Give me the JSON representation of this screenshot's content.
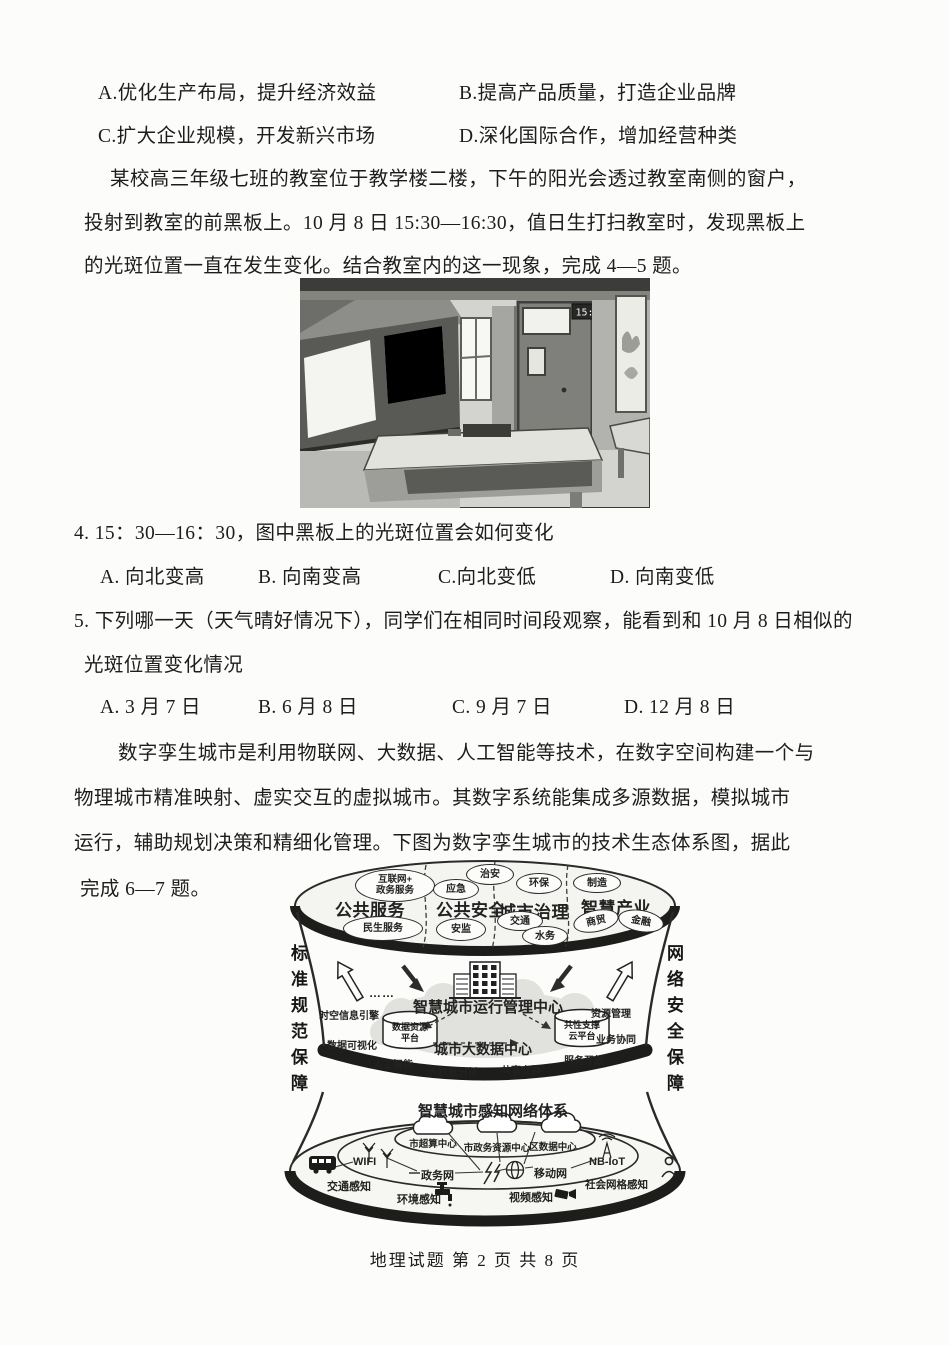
{
  "page": {
    "footer": "地理试题  第 2 页 共 8 页"
  },
  "prev_question": {
    "option_a": "A.优化生产布局，提升经济效益",
    "option_b": "B.提高产品质量，打造企业品牌",
    "option_c": "C.扩大企业规模，开发新兴市场",
    "option_d": "D.深化国际合作，增加经营种类"
  },
  "passage_classroom": {
    "line1": "某校高三年级七班的教室位于教学楼二楼，下午的阳光会透过教室南侧的窗户，",
    "line2": "投射到教室的前黑板上。10 月 8 日 15:30—16:30，值日生打扫教室时，发现黑板上",
    "line3": "的光斑位置一直在发生变化。结合教室内的这一现象，完成 4—5 题。"
  },
  "classroom_photo": {
    "clock_time": "15:30"
  },
  "question4": {
    "stem": "4. 15：30—16：30，图中黑板上的光斑位置会如何变化",
    "option_a": "A. 向北变高",
    "option_b": "B. 向南变高",
    "option_c": "C.向北变低",
    "option_d": "D. 向南变低"
  },
  "question5": {
    "stem_line1": "5. 下列哪一天（天气晴好情况下），同学们在相同时间段观察，能看到和 10 月 8 日相似的",
    "stem_line2": "光斑位置变化情况",
    "option_a": "A. 3 月 7 日",
    "option_b": "B. 6 月 8 日",
    "option_c": "C. 9 月 7 日",
    "option_d": "D. 12 月 8 日"
  },
  "passage_twin_city": {
    "line1": "数字孪生城市是利用物联网、大数据、人工智能等技术，在数字空间构建一个与",
    "line2": "物理城市精准映射、虚实交互的虚拟城市。其数字系统能集成多源数据，模拟城市",
    "line3": "运行，辅助规划决策和精细化管理。下图为数字孪生城市的技术生态体系图，据此",
    "line4": "完成 6—7 题。"
  },
  "diagram": {
    "left_guarantee": "标准规范保障",
    "right_guarantee": "网络安全保障",
    "sectors": {
      "s1": "公共服务",
      "s2": "公共安全",
      "s3": "城市治理",
      "s4": "智慧产业"
    },
    "bubbles": {
      "internet_gov": "互联网+\n政务服务",
      "minsheng": "民生服务",
      "zhian": "治安",
      "yingji": "应急",
      "anjian": "安监",
      "huanbao": "环保",
      "jiaotong": "交通",
      "shuiwu": "水务",
      "zhizao": "制造",
      "shangmao": "商贸",
      "jinrong": "金融"
    },
    "middle": {
      "ops_center": "智慧城市运行管理中心",
      "big_data_center": "城市大数据中心",
      "cyl_data_resource": "数据资源\n平台",
      "cyl_common_cloud": "共性支撑\n云平台",
      "dots": "……",
      "spatiotemporal": "时空信息引擎",
      "visualization": "数据可视化",
      "ai": "人工智能",
      "bigdata_analysis": "大数据分析",
      "share_exchange": "共享交换",
      "resource_mgmt": "资源管理",
      "business_collab": "业务协同",
      "service_open": "服务开放"
    },
    "bottom": {
      "sense_title": "智慧城市感知网络体系",
      "cloud1": "市超算中心",
      "cloud2": "市政务资源中心",
      "cloud3": "区数据中心",
      "wifi": "WIFI",
      "nbiot": "NB-IoT",
      "gov_net": "政务网",
      "mobile_net": "移动网",
      "sense_traffic": "交通感知",
      "sense_env": "环境感知",
      "sense_video": "视频感知",
      "sense_social": "社会网格感知"
    }
  }
}
